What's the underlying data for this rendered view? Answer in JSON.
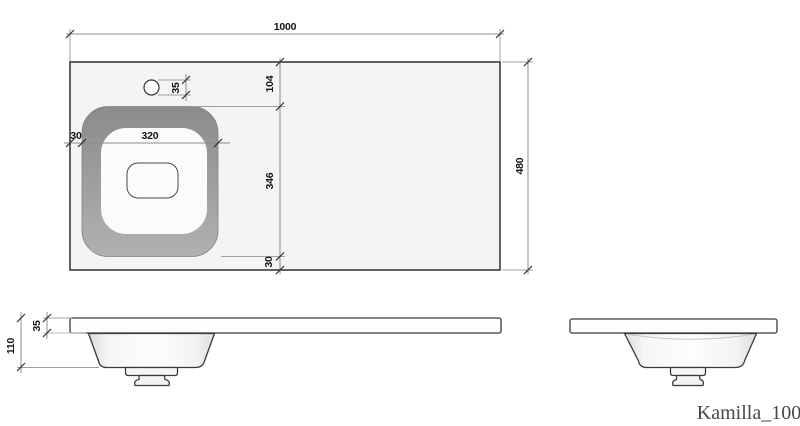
{
  "drawing_title": "Kamilla_100",
  "top_view": {
    "width_mm": "1000",
    "depth_mm": "480",
    "faucet_hole_diameter_mm": "35",
    "basin_top_offset_mm": "104",
    "basin_outer_depth_mm": "346",
    "basin_bottom_offset_mm": "30",
    "basin_left_offset_mm": "30",
    "basin_outer_width_mm": "320"
  },
  "front_view": {
    "countertop_thickness_mm": "35",
    "overall_height_mm": "110"
  },
  "colors": {
    "background": "#ffffff",
    "countertop_fill": "#f4f4f4",
    "sink_rim_gray": "#9c9c9c",
    "basin_fill": "#fbfbfb",
    "outline_dark": "#3a3a3a",
    "dimension_line": "#8c8c8c",
    "dimension_text": "#151515",
    "label_text": "#47474f"
  }
}
